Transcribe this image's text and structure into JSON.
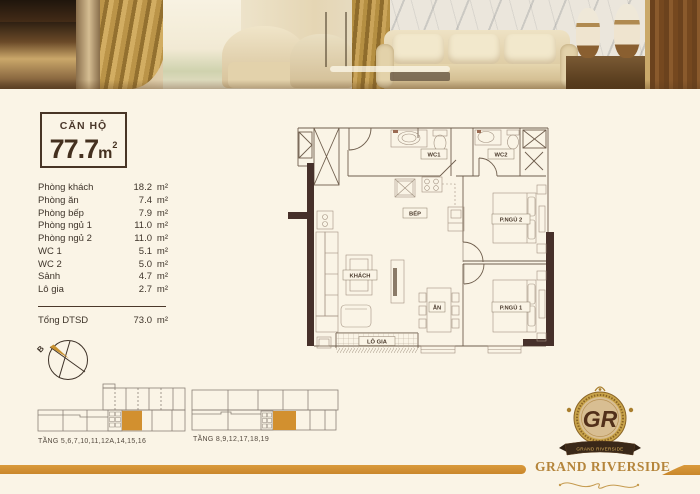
{
  "colors": {
    "accent_orange": "#D2902F",
    "dark_brown": "#44301F",
    "cream_background": "#FAF4E6",
    "wall_fill": "#46302A"
  },
  "unit_card": {
    "title": "CĂN HỘ",
    "area": "77.7",
    "unit": "m",
    "sup": "2"
  },
  "areas": {
    "unit_suffix": "m²",
    "rows": [
      {
        "label": "Phòng khách",
        "value": "18.2"
      },
      {
        "label": "Phòng ăn",
        "value": "7.4"
      },
      {
        "label": "Phòng bếp",
        "value": "7.9"
      },
      {
        "label": "Phòng ngủ 1",
        "value": "11.0"
      },
      {
        "label": "Phòng ngủ 2",
        "value": "11.0"
      },
      {
        "label": "WC 1",
        "value": "5.1"
      },
      {
        "label": "WC 2",
        "value": "5.0"
      },
      {
        "label": "Sảnh",
        "value": "4.7"
      },
      {
        "label": "Lô gia",
        "value": "2.7"
      }
    ],
    "total_label": "Tổng DTSD",
    "total_value": "73.0"
  },
  "compass": {
    "north_label": "B"
  },
  "floor_plan": {
    "labels": {
      "wc1": "WC1",
      "wc2": "WC2",
      "bep": "BẾP",
      "khach": "KHÁCH",
      "an": "ĂN",
      "bedroom2": "P.NGỦ 2",
      "bedroom1": "P.NGỦ 1",
      "logia": "LÔ GIA"
    }
  },
  "floor_key": {
    "left_label": "TẦNG 5,6,7,10,11,12A,14,15,16",
    "right_label": "TẦNG 8,9,12,17,18,19"
  },
  "brand": {
    "monogram": "GR",
    "ribbon": "GRAND RIVERSIDE",
    "wordmark": "GRAND RIVERSIDE"
  }
}
